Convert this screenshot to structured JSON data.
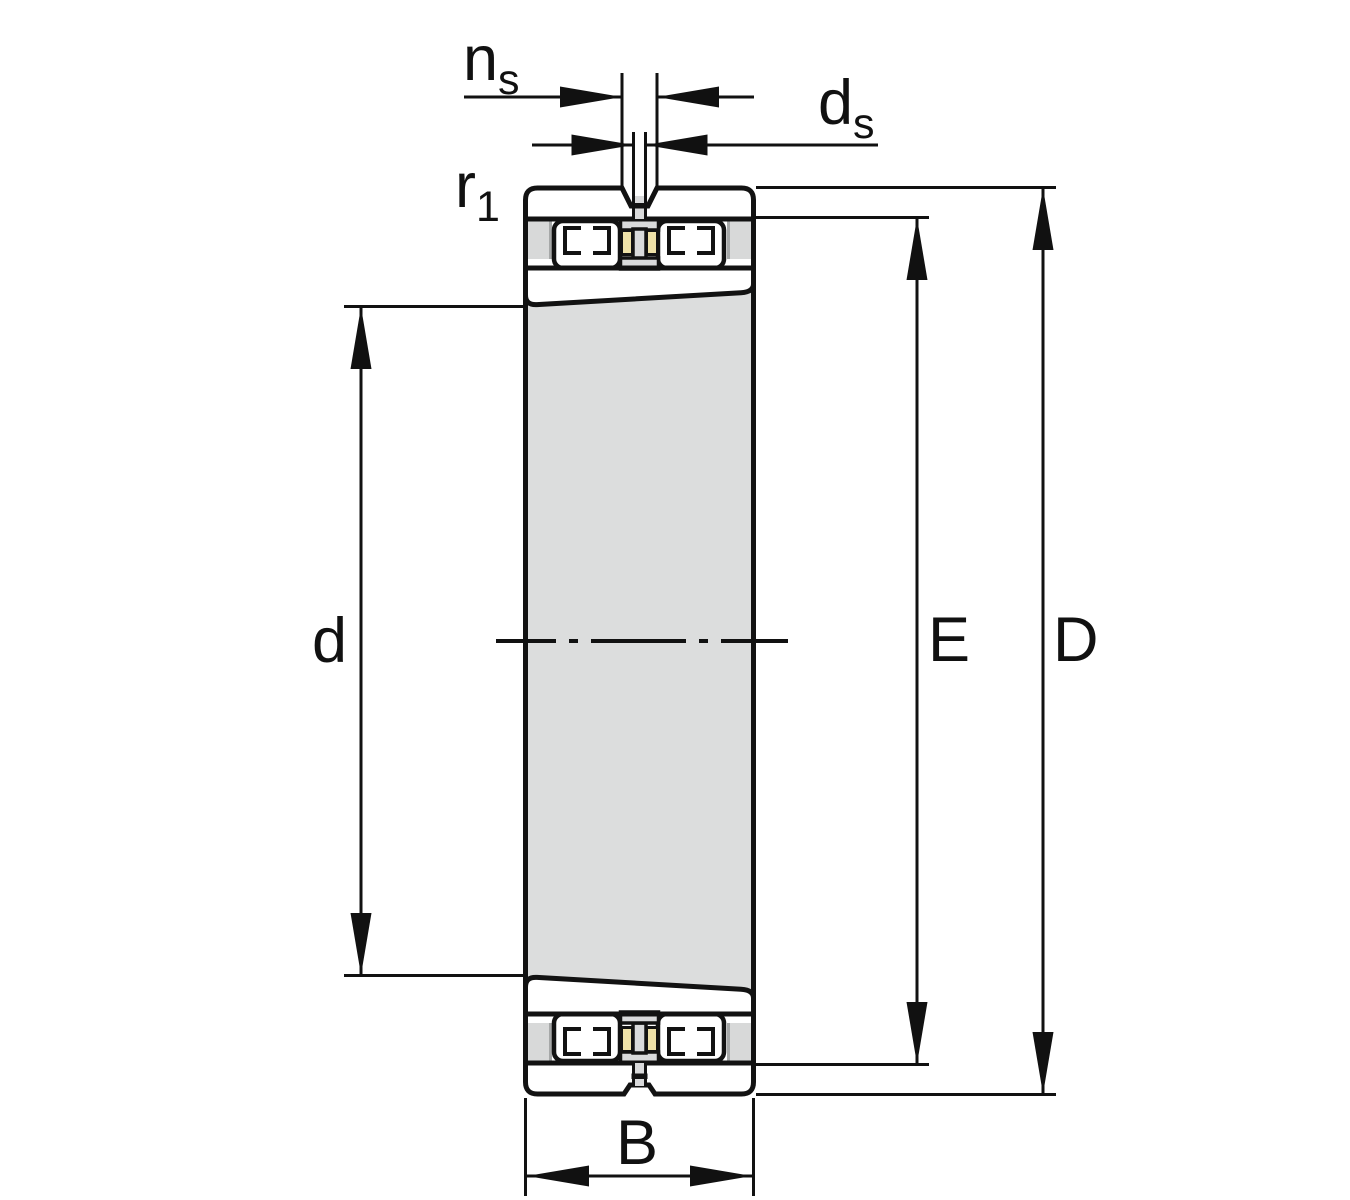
{
  "figure": {
    "description": "Sectional technical drawing of a double-row cylindrical roller bearing with tapered bore and outer-ring lubrication groove and hole",
    "dimension_labels": {
      "ns": {
        "base": "n",
        "sub": "s"
      },
      "ds": {
        "base": "d",
        "sub": "s"
      },
      "r1": {
        "base": "r",
        "sub": "1"
      },
      "bore_diameter": {
        "base": "d",
        "sub": ""
      },
      "raceway_diameter": {
        "base": "E",
        "sub": ""
      },
      "outside_diameter": {
        "base": "D",
        "sub": ""
      },
      "width": {
        "base": "B",
        "sub": ""
      }
    },
    "colors": {
      "ring_teal": "#a6cdcb",
      "highlight_white": "#ffffff",
      "bore_gray": "#dcdddd",
      "stripe_gray": "#d8d9d9",
      "stripe_edge_gray": "#a6a8a8",
      "cage_yellow": "#eee1a8",
      "hole_gray": "#d9dadb",
      "line_black": "#121212",
      "background": "#ffffff"
    }
  }
}
